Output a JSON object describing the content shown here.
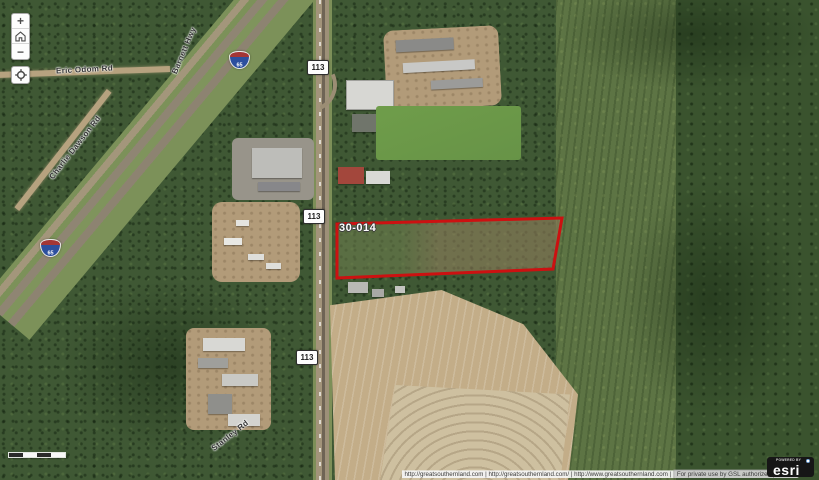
{
  "map": {
    "parcel": {
      "label": "30-014",
      "outline_color": "#cc1111"
    },
    "road_labels": [
      {
        "id": "eric-odom-rd",
        "text": "Eric Odom Rd"
      },
      {
        "id": "barnett-hwy",
        "text": "Barnett Hwy"
      },
      {
        "id": "charlie-dawson-rd",
        "text": "Charlie Dawson Rd"
      },
      {
        "id": "stanley-rd",
        "text": "Stanley Rd"
      }
    ],
    "route_markers": [
      {
        "text": "113"
      },
      {
        "text": "113"
      },
      {
        "text": "113"
      }
    ],
    "interstate_shields": [
      {
        "text": "65"
      },
      {
        "text": "65"
      }
    ]
  },
  "controls": {
    "zoom_in": "+",
    "zoom_out": "−",
    "icons": {
      "zoom_in": "plus",
      "home": "house",
      "zoom_out": "minus",
      "locate": "crosshair-circle"
    }
  },
  "attribution": {
    "links": "http://greatsouthernland.com | http://greatsouthernland.com/ | http://www.greatsouthernland.com |",
    "notice": "For private use by GSL authorized persons"
  },
  "esri": {
    "powered_by": "POWERED BY",
    "logo": "esri"
  },
  "colors": {
    "parcel_outline": "#cc1111",
    "forest": "#3f5834",
    "field": "#c3ad88"
  }
}
